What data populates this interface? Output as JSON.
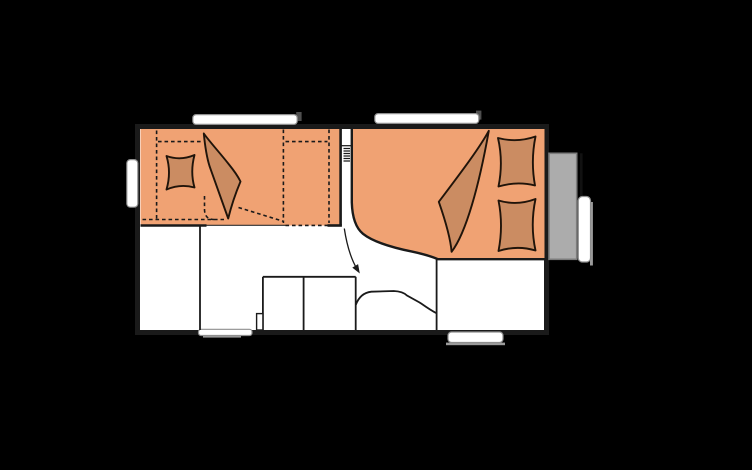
{
  "title": "Caravan floor plan (top view)",
  "diagram_type": "floorplan",
  "colors": {
    "background": "#000000",
    "floor": "#ffffff",
    "wall": "#1a1a1a",
    "line": "#1a1a1a",
    "upholstery": "#f0a273",
    "bedding": "#cb8c62",
    "bedding_outline": "#20140a",
    "locker_gray": "#acacac",
    "locker_border": "#7c7c7c",
    "window_fill": "#ffffff",
    "window_border": "#8f8f8f",
    "shadow_gray": "#9b9b9b",
    "tab_gray": "#4f4f4f"
  },
  "features": [
    {
      "name": "rear-lounge-berth"
    },
    {
      "name": "rear-pillow"
    },
    {
      "name": "rear-folded-duvet"
    },
    {
      "name": "bunk-dashed-outlines"
    },
    {
      "name": "concertina-partition-coil"
    },
    {
      "name": "entry-path-arrow"
    },
    {
      "name": "kitchen-unit"
    },
    {
      "name": "kitchen-step"
    },
    {
      "name": "wheel-arch"
    },
    {
      "name": "washroom"
    },
    {
      "name": "front-double-bed"
    },
    {
      "name": "front-pillow-upper"
    },
    {
      "name": "front-pillow-lower"
    },
    {
      "name": "front-folded-duvet"
    },
    {
      "name": "gas-locker"
    },
    {
      "name": "front-window-bar"
    },
    {
      "name": "roof-window-left"
    },
    {
      "name": "roof-window-right"
    },
    {
      "name": "rear-window"
    },
    {
      "name": "bottom-window"
    },
    {
      "name": "entry-door"
    }
  ]
}
